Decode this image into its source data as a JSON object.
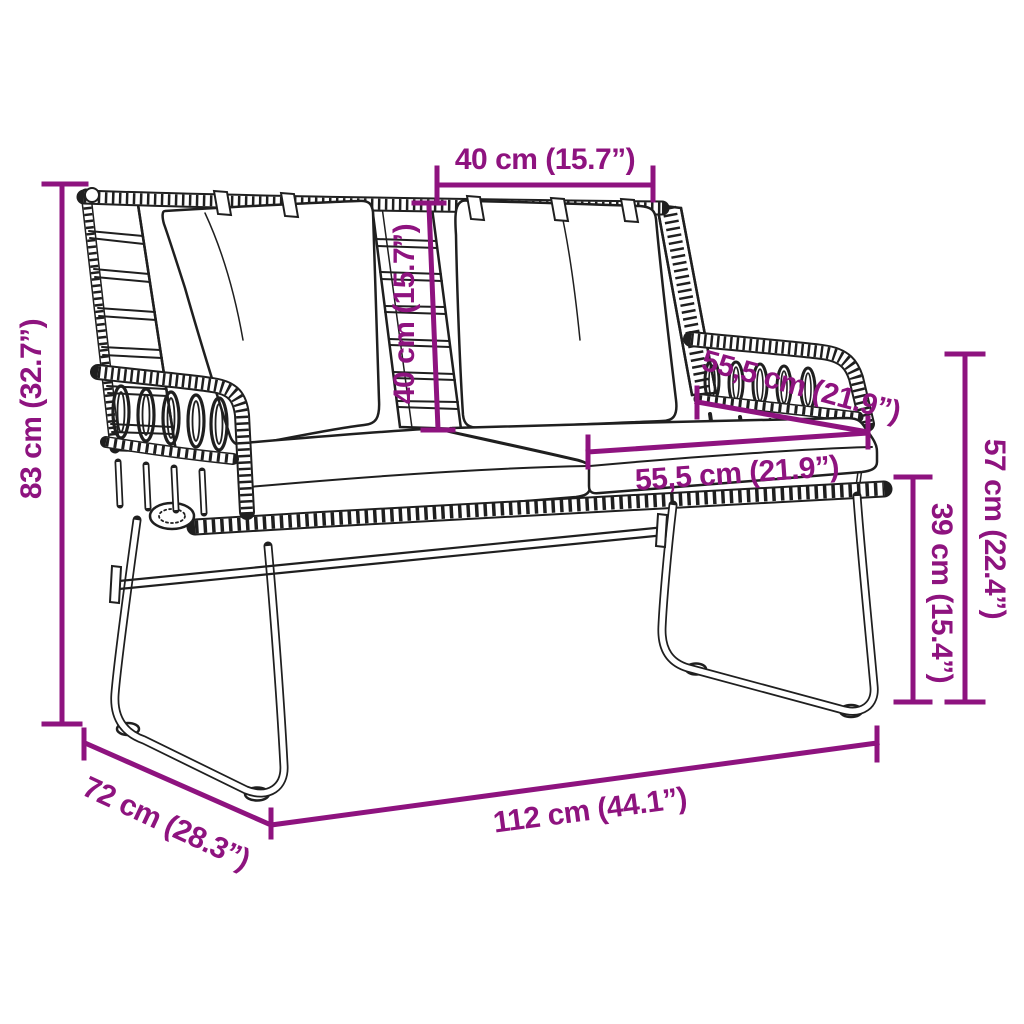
{
  "meta": {
    "kind": "product-dimension-diagram",
    "subject": "poly rattan garden bench with cushions",
    "background_color": "#ffffff",
    "artwork_color": "#1f1f1f",
    "dimension_color": "#8E137F"
  },
  "dimensions": [
    {
      "name": "back-cushion-width",
      "label": "40 cm (15.7”)",
      "value_cm": "40",
      "value_in": "15.7"
    },
    {
      "name": "back-cushion-height",
      "label": "40 cm (15.7”)",
      "value_cm": "40",
      "value_in": "15.7"
    },
    {
      "name": "armrest-length",
      "label": "55,5 cm (21.9”)",
      "value_cm": "55,5",
      "value_in": "21.9"
    },
    {
      "name": "seat-depth",
      "label": "55,5 cm (21.9”)",
      "value_cm": "55,5",
      "value_in": "21.9"
    },
    {
      "name": "armrest-height",
      "label": "57 cm (22.4”)",
      "value_cm": "57",
      "value_in": "22.4"
    },
    {
      "name": "seat-height",
      "label": "39 cm (15.4”)",
      "value_cm": "39",
      "value_in": "15.4"
    },
    {
      "name": "total-height",
      "label": "83 cm (32.7”)",
      "value_cm": "83",
      "value_in": "32.7"
    },
    {
      "name": "total-depth",
      "label": "72 cm (28.3”)",
      "value_cm": "72",
      "value_in": "28.3"
    },
    {
      "name": "total-width",
      "label": "112 cm (44.1”)",
      "value_cm": "112",
      "value_in": "44.1"
    }
  ]
}
